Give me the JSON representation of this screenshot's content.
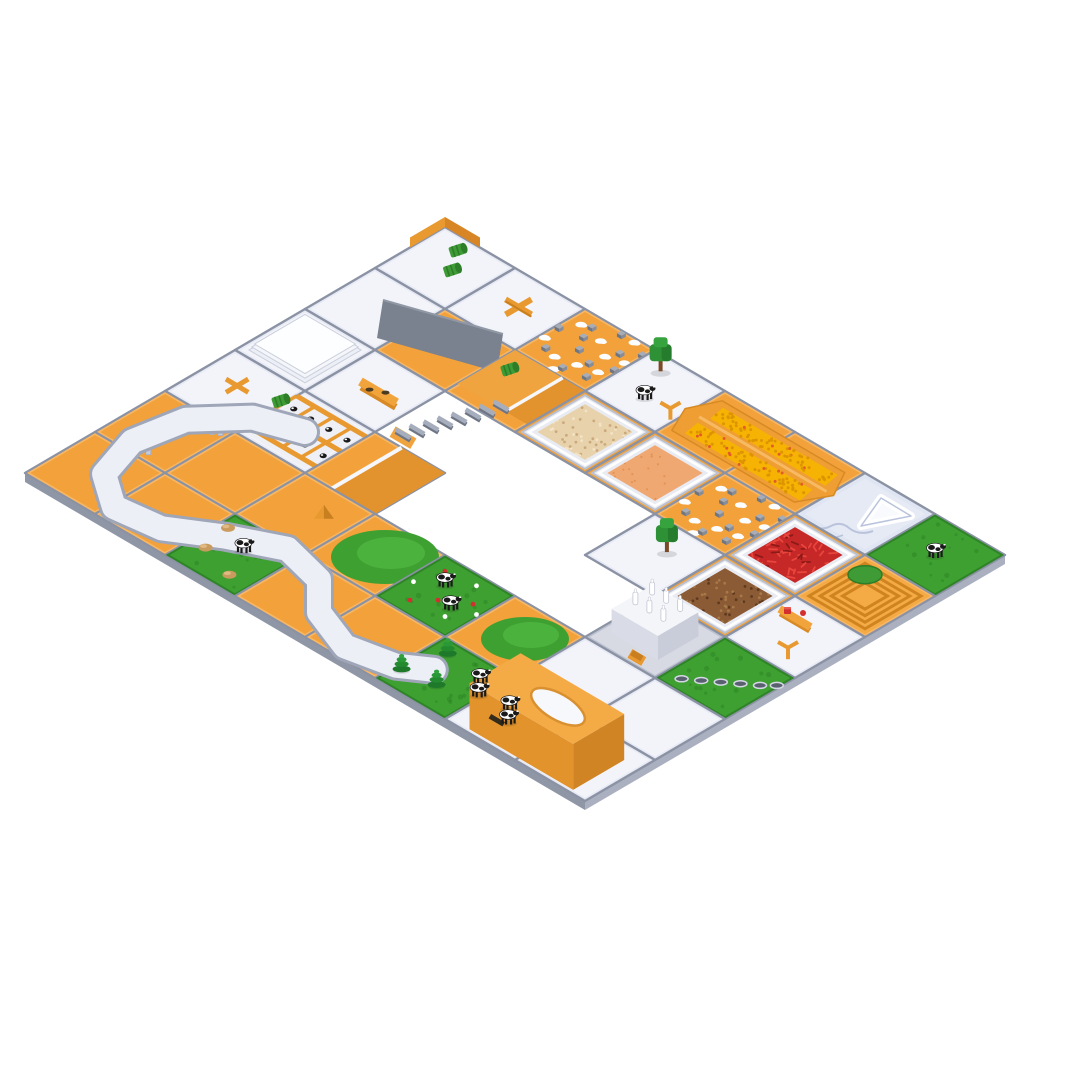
{
  "scene": {
    "description": "isometric-farm-game-board-render",
    "background": "#FFFFFF",
    "colors": {
      "orange": "#F3A23B",
      "orangeDark": "#D88A26",
      "orangeLight": "#F7B765",
      "white": "#E7EAF4",
      "whiteTop": "#F3F4FA",
      "grass": "#3FA032",
      "grassDark": "#2E8426",
      "ice": "#DFE5F2",
      "iceLine": "#B9C3DC",
      "grout": "#8A92A4",
      "edgeLeft": "#8F96A6",
      "edgeRight": "#AAB0BF",
      "road": "#EDEFF7",
      "roadEdge": "#9FA6B8",
      "leg": "#C6CAD6",
      "grayRamp": "#7A818F",
      "corn": "#F6B303",
      "cornMound": "#EE9E33",
      "cornDot": "#DE9400",
      "chili": "#C62828",
      "chiliLight": "#E8453C",
      "seeds": "#8A5B35",
      "seedsDark": "#5E3A1F",
      "seedsLight": "#A87848",
      "grain": "#E8D2AC",
      "grainDark": "#CBA97C",
      "sand": "#F0A872",
      "sandDark": "#E39455",
      "tray": "#E9EBF3",
      "trayEdge": "#BCC1CF",
      "red": "#D32F2F",
      "cowBlack": "#1A1A1A",
      "cowWhite": "#FFFFFF",
      "treeGreen": "#2E9135",
      "treeLight": "#37A33F",
      "treeDark": "#1F6B24",
      "trunk": "#7A4A28",
      "coneTree": "#1E7A2A",
      "bale": "#3E9B35",
      "baleDark": "#2E7D28",
      "hay": "#C99B5F",
      "hayLight": "#E0BA84",
      "marker": "#E8992F",
      "markerDark": "#C77F1F",
      "factoryWall": "#D9DCE6",
      "factoryTop": "#F4F5F9",
      "platform": "#D7DAE3",
      "barnTop": "#F5AB45",
      "barnLeft": "#E2932C",
      "barnRight": "#D08424",
      "slot": "#332B1C",
      "holeFill": "#596070",
      "holeRim": "#D4D8E2",
      "rockTop": "#A6ACB8",
      "rockFront": "#6F7682",
      "rockSide": "#868D9A"
    }
  },
  "board": {
    "cols": 8,
    "rows": 6,
    "origin": {
      "x": 445,
      "y": 268
    },
    "tile": {
      "halfW": 70,
      "halfH": 41
    },
    "tiles": [
      {
        "u": 0,
        "v": 0,
        "base": "white",
        "deco": "vwall",
        "items": [
          [
            "bale",
            -0.12,
            -0.3
          ],
          [
            "bale",
            0.08,
            -0.02
          ]
        ]
      },
      {
        "u": 1,
        "v": 0,
        "base": "white",
        "items": [
          [
            "plus",
            0,
            -0.05
          ]
        ]
      },
      {
        "u": 2,
        "v": 0,
        "base": "orange",
        "deco": "rocks"
      },
      {
        "u": 3,
        "v": 0,
        "base": "white",
        "items": [
          [
            "tree",
            -0.2,
            -0.28
          ],
          [
            "cow",
            0.0,
            0.15
          ],
          [
            "ymark",
            0.32,
            0.1
          ]
        ]
      },
      {
        "u": 4,
        "v": 0,
        "base": "orange"
      },
      {
        "u": 5,
        "v": 0,
        "base": "orange"
      },
      {
        "u": 6,
        "v": 0,
        "base": "ice",
        "deco": "ice"
      },
      {
        "u": 7,
        "v": 0,
        "base": "grass",
        "items": [
          [
            "cow",
            0,
            0
          ]
        ]
      },
      {
        "u": 0,
        "v": 1,
        "base": "white"
      },
      {
        "u": 1,
        "v": 1,
        "base": "orange",
        "deco": "grayramp"
      },
      {
        "u": 2,
        "v": 1,
        "base": "orange",
        "deco": "rampdl",
        "items": [
          [
            "bale",
            -0.3,
            -0.22
          ]
        ]
      },
      {
        "u": 3,
        "v": 1,
        "base": "tray",
        "mat": "grain"
      },
      {
        "u": 4,
        "v": 1,
        "base": "tray",
        "mat": "sand"
      },
      {
        "u": 5,
        "v": 1,
        "base": "orange",
        "deco": "rocks"
      },
      {
        "u": 6,
        "v": 1,
        "base": "tray",
        "mat": "chili"
      },
      {
        "u": 7,
        "v": 1,
        "base": "orange",
        "deco": "terraced"
      },
      {
        "u": 0,
        "v": 2,
        "base": "white",
        "deco": "glossy"
      },
      {
        "u": 1,
        "v": 2,
        "base": "white",
        "items": [
          [
            "bench2",
            0.05,
            0.0
          ]
        ]
      },
      {
        "u": 2,
        "v": 2,
        "base": "hole"
      },
      {
        "u": 3,
        "v": 2,
        "base": "hole"
      },
      {
        "u": 4,
        "v": 2,
        "base": "hole"
      },
      {
        "u": 5,
        "v": 2,
        "base": "white",
        "items": [
          [
            "tree",
            0.05,
            -0.12
          ]
        ]
      },
      {
        "u": 6,
        "v": 2,
        "base": "tray",
        "mat": "seeds"
      },
      {
        "u": 7,
        "v": 2,
        "base": "white",
        "items": [
          [
            "benchred",
            -0.22,
            -0.22
          ],
          [
            "ymark",
            0.08,
            0.18
          ]
        ]
      },
      {
        "u": 0,
        "v": 3,
        "base": "white",
        "items": [
          [
            "xmark",
            -0.05,
            -0.08
          ]
        ]
      },
      {
        "u": 1,
        "v": 3,
        "base": "white",
        "deco": "pens",
        "items": [
          [
            "bale",
            -0.55,
            -0.2
          ]
        ]
      },
      {
        "u": 2,
        "v": 3,
        "base": "orange",
        "deco": "rampwt"
      },
      {
        "u": 3,
        "v": 3,
        "base": "hole"
      },
      {
        "u": 4,
        "v": 3,
        "base": "hole"
      },
      {
        "u": 5,
        "v": 3,
        "base": "hole"
      },
      {
        "u": 6,
        "v": 3,
        "base": "white",
        "deco": "factory"
      },
      {
        "u": 7,
        "v": 3,
        "base": "grass",
        "deco": "gholes"
      },
      {
        "u": 0,
        "v": 4,
        "base": "orange"
      },
      {
        "u": 1,
        "v": 4,
        "base": "orange"
      },
      {
        "u": 2,
        "v": 4,
        "base": "orange",
        "items": [
          [
            "tent",
            0.12,
            -0.15
          ]
        ]
      },
      {
        "u": 3,
        "v": 4,
        "base": "orange",
        "deco": "hill"
      },
      {
        "u": 4,
        "v": 4,
        "base": "grass",
        "deco": "flowers",
        "items": [
          [
            "cow",
            -0.14,
            -0.14
          ],
          [
            "cow",
            0.18,
            0.1
          ]
        ]
      },
      {
        "u": 5,
        "v": 4,
        "base": "orange",
        "deco": "hill2"
      },
      {
        "u": 6,
        "v": 4,
        "base": "white"
      },
      {
        "u": 7,
        "v": 4,
        "base": "white"
      },
      {
        "u": 0,
        "v": 5,
        "base": "orange"
      },
      {
        "u": 1,
        "v": 5,
        "base": "orange"
      },
      {
        "u": 2,
        "v": 5,
        "base": "grass",
        "items": [
          [
            "cow",
            0,
            -0.12
          ],
          [
            "hay",
            -0.3,
            0.12
          ],
          [
            "hay",
            0.2,
            0.28
          ],
          [
            "hay",
            -0.38,
            -0.28
          ]
        ]
      },
      {
        "u": 3,
        "v": 5,
        "base": "orange"
      },
      {
        "u": 4,
        "v": 5,
        "base": "orange"
      },
      {
        "u": 5,
        "v": 5,
        "base": "grass",
        "items": [
          [
            "conetree",
            -0.28,
            -0.32
          ],
          [
            "conetree",
            0.02,
            0.14
          ],
          [
            "conetree",
            -0.42,
            0.2
          ],
          [
            "cow",
            0.28,
            -0.22
          ],
          [
            "cow",
            0.44,
            -0.04
          ]
        ]
      },
      {
        "u": 6,
        "v": 5,
        "base": "white",
        "items": [
          [
            "cow",
            -0.18,
            -0.1
          ],
          [
            "cow",
            -0.02,
            0.08
          ]
        ]
      },
      {
        "u": 7,
        "v": 5,
        "base": "white",
        "deco": "barn"
      }
    ],
    "road": {
      "width": 24,
      "points": [
        [
          1.0,
          3.0
        ],
        [
          0.45,
          3.2
        ],
        [
          0.0,
          3.7
        ],
        [
          -0.12,
          4.35
        ],
        [
          0.08,
          4.95
        ],
        [
          0.55,
          5.28
        ],
        [
          1.15,
          5.2
        ],
        [
          1.7,
          4.85
        ],
        [
          2.3,
          4.55
        ],
        [
          2.9,
          4.7
        ],
        [
          3.3,
          5.1
        ],
        [
          3.9,
          5.33
        ],
        [
          4.5,
          5.2
        ],
        [
          4.82,
          4.98
        ]
      ],
      "legs": [
        [
          0.22,
          3.55
        ],
        [
          -0.06,
          4.3
        ],
        [
          0.22,
          5.05
        ],
        [
          0.9,
          5.26
        ],
        [
          1.95,
          4.68
        ],
        [
          2.62,
          4.58
        ]
      ]
    },
    "stairs": {
      "from": [
        2.08,
        1.28
      ],
      "to": [
        1.72,
        2.32
      ],
      "steps": 8
    },
    "corn": {
      "u1": 3.55,
      "u2": 5.45,
      "v": 0
    }
  },
  "patterns": {
    "rocks": [
      [
        -0.45,
        -0.08
      ],
      [
        -0.22,
        -0.32
      ],
      [
        0.08,
        -0.44
      ],
      [
        0.3,
        -0.2
      ],
      [
        0.46,
        0.04
      ],
      [
        0.2,
        0.14
      ],
      [
        -0.04,
        0.04
      ],
      [
        -0.3,
        0.26
      ],
      [
        0.06,
        0.38
      ],
      [
        0.34,
        0.32
      ],
      [
        -0.16,
        -0.14
      ],
      [
        0.48,
        -0.34
      ]
    ],
    "blobs": [
      [
        -0.34,
        -0.28
      ],
      [
        0.0,
        -0.22
      ],
      [
        0.26,
        -0.44
      ],
      [
        0.44,
        -0.12
      ],
      [
        -0.14,
        0.3
      ],
      [
        0.12,
        0.24
      ],
      [
        0.36,
        0.18
      ],
      [
        -0.44,
        0.14
      ],
      [
        0.0,
        0.46
      ],
      [
        0.22,
        -0.06
      ]
    ],
    "gholes": [
      [
        -0.3,
        0.32
      ],
      [
        -0.14,
        0.2
      ],
      [
        0.02,
        0.08
      ],
      [
        0.18,
        -0.04
      ],
      [
        0.34,
        -0.16
      ],
      [
        0.46,
        -0.28
      ]
    ],
    "flowers": [
      [
        -0.3,
        -0.3,
        "r"
      ],
      [
        0.1,
        -0.35,
        "w"
      ],
      [
        0.3,
        -0.1,
        "r"
      ],
      [
        -0.4,
        0.05,
        "w"
      ],
      [
        0.0,
        0.1,
        "r"
      ],
      [
        0.25,
        0.25,
        "w"
      ],
      [
        -0.2,
        0.3,
        "r"
      ],
      [
        0.45,
        0.0,
        "w"
      ]
    ],
    "pencows": [
      [
        -0.36,
        -0.2
      ],
      [
        -0.12,
        -0.2
      ],
      [
        0.14,
        -0.2
      ],
      [
        0.4,
        -0.2
      ],
      [
        -0.36,
        0.16
      ],
      [
        -0.1,
        0.16
      ],
      [
        0.16,
        0.16
      ],
      [
        0.42,
        0.16
      ],
      [
        0.02,
        -0.02
      ]
    ]
  }
}
